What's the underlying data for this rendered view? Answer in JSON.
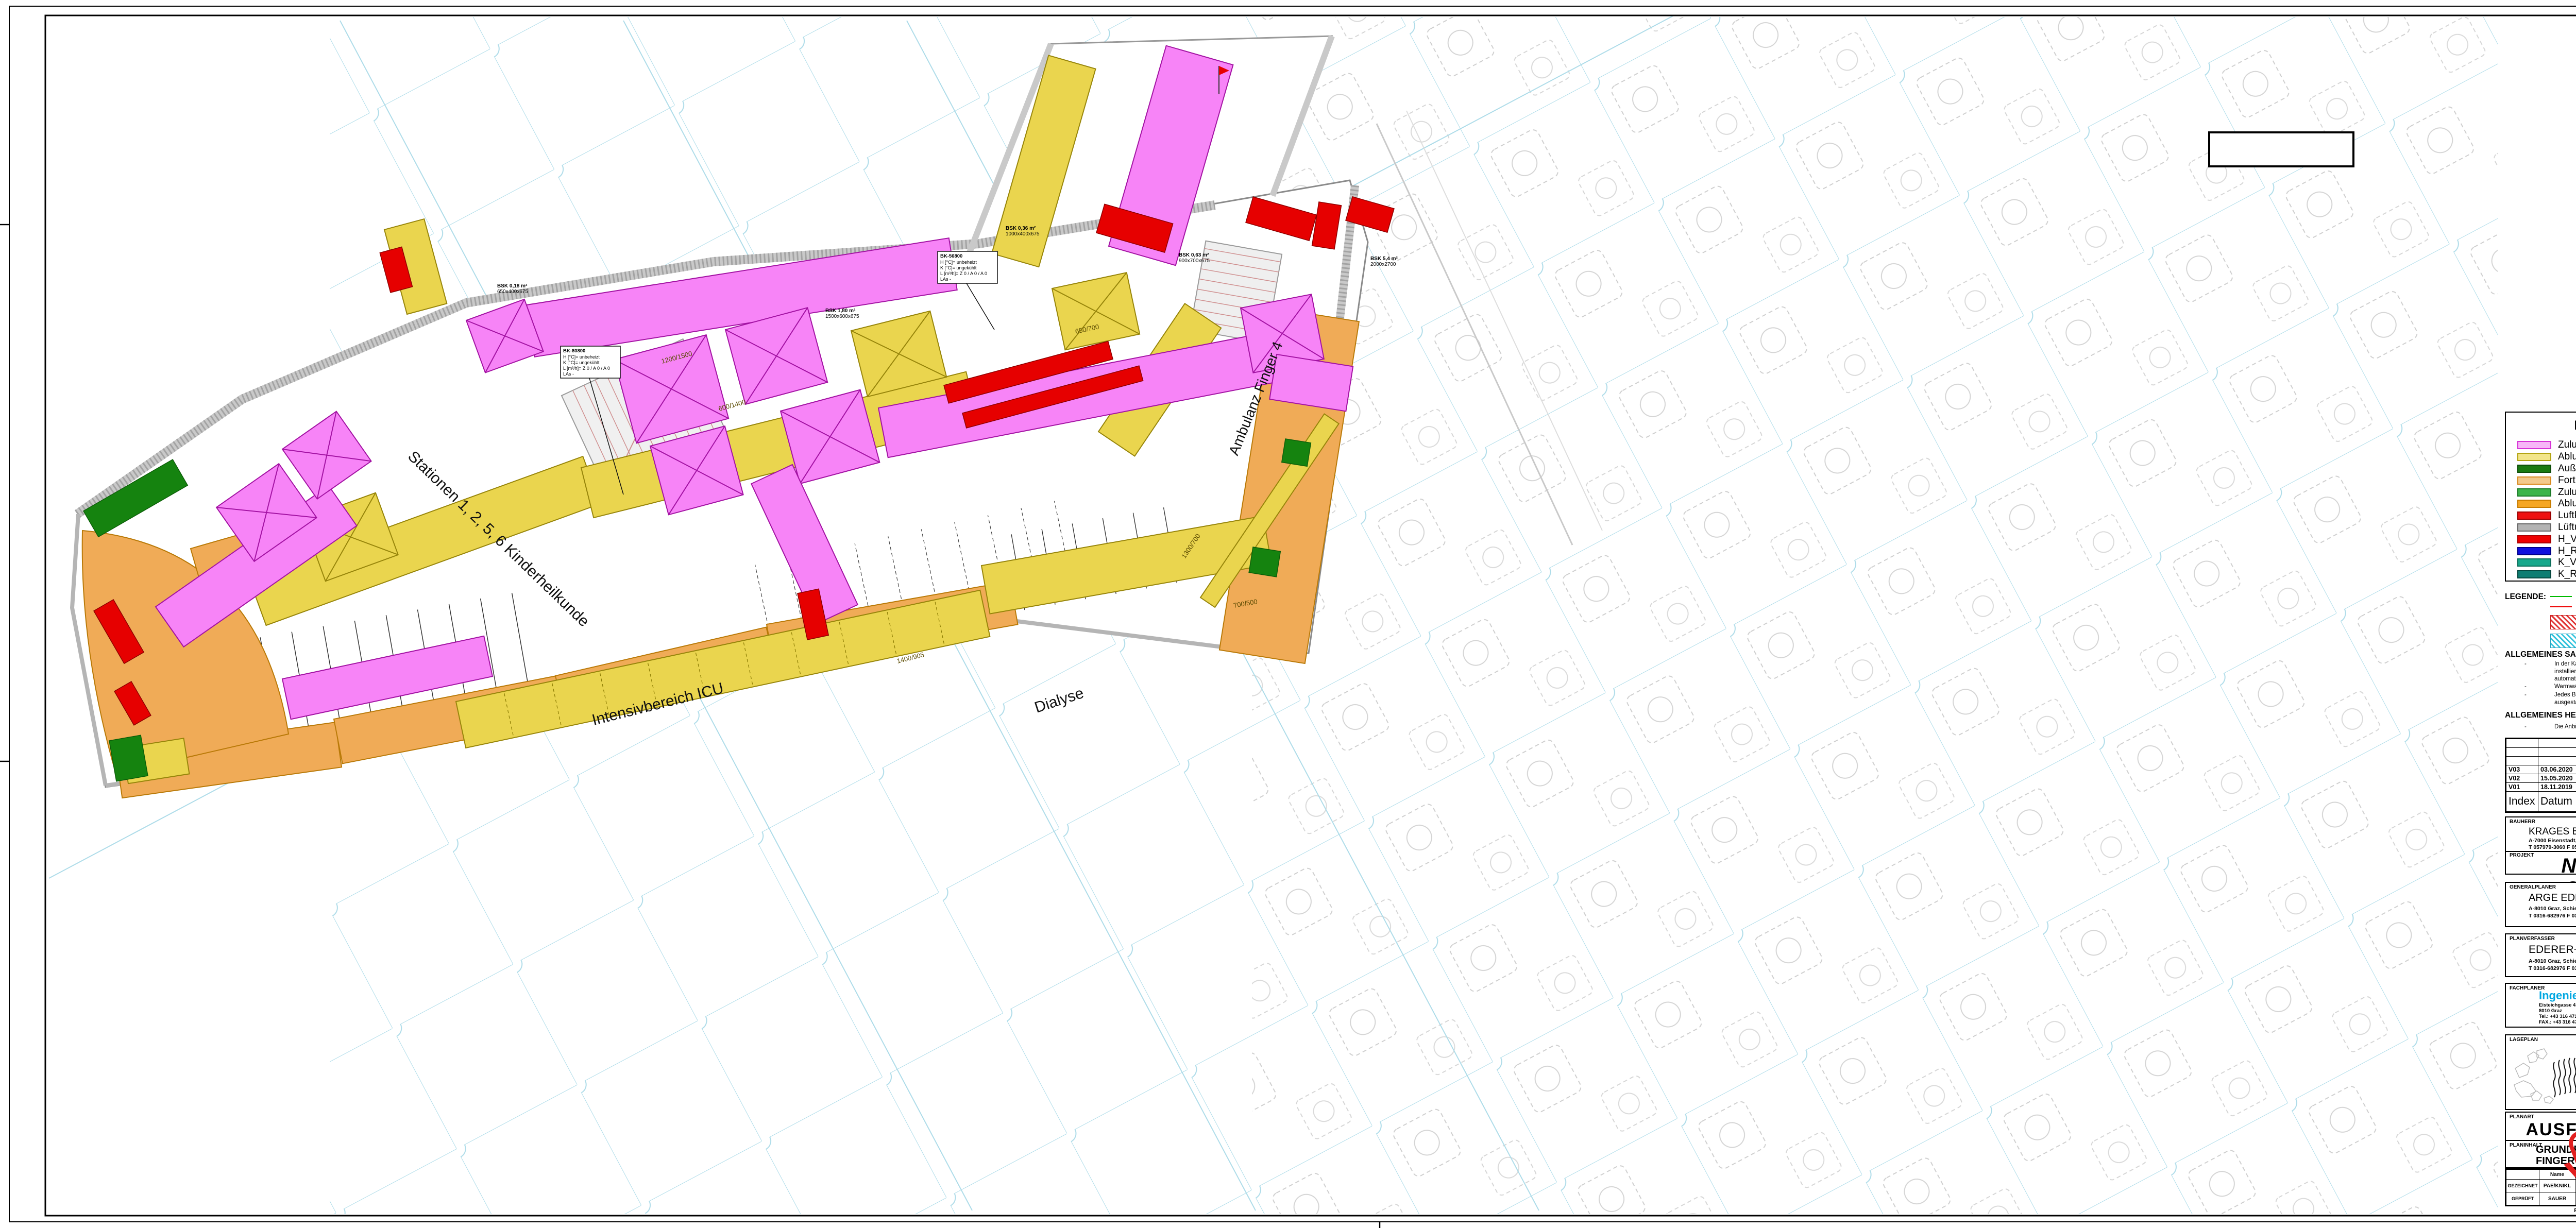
{
  "palette": {
    "zuluft": "#f784f7",
    "abluft": "#ead54e",
    "fortluft": "#f0ab57",
    "aussenluft": "#15830f",
    "damper": "#e60000",
    "wall": "#c9c9c9",
    "grid": "#aedce9",
    "stair": "#cf8f8f"
  },
  "plan": {
    "labels": {
      "stationen": "Stationen 1, 2, 5, 6 Kinderheilkunde",
      "icu": "Intensivbereich ICU",
      "dialyse": "Dialyse",
      "ambulanz": "Ambulanz Finger 4"
    },
    "tags": {
      "bk1": [
        "BK-80800",
        "H [°C]= unbeheizt",
        "K [°C]= ungekühlt",
        "L [m³/h]= Z 0 / A 0 / A 0",
        "LAs -"
      ],
      "bk2": [
        "BK-56800",
        "H [°C]= unbeheizt",
        "K [°C]= ungekühlt",
        "L [m³/h]= Z 0 / A 0 / A 0",
        "LAs -"
      ]
    },
    "bsk": [
      {
        "l1": "BSK 0,36 m²",
        "l2": "1000x400x675"
      },
      {
        "l1": "BSK 5,4 m²",
        "l2": "2000x2700"
      },
      {
        "l1": "BSK 0,63 m²",
        "l2": "900x700x675"
      },
      {
        "l1": "BSK 1,80 m²",
        "l2": "1500x600x675"
      },
      {
        "l1": "BSK 0,18 m²",
        "l2": "650x400x675"
      }
    ],
    "dims": [
      "1400/905",
      "1200/1500",
      "600/1400",
      "650/700",
      "1300/700",
      "700/500"
    ]
  },
  "legend": {
    "title": "LEGENDE-HKLS",
    "left": [
      {
        "label": "Zuluft",
        "fill": "#f7b7f7",
        "stroke": "#d633d6"
      },
      {
        "label": "Abluft",
        "fill": "#f2e58a",
        "stroke": "#b3a412"
      },
      {
        "label": "Außenluft",
        "fill": "#1a7a12",
        "stroke": "#0d4d09"
      },
      {
        "label": "Fortluft",
        "fill": "#f2c98c",
        "stroke": "#d98a1f"
      },
      {
        "label": "Zuluft DBA",
        "fill": "#3cb54a",
        "stroke": "#1c7a28"
      },
      {
        "label": "Abluft DBA",
        "fill": "#f5a623",
        "stroke": "#c77c00"
      },
      {
        "label": "Luftkanalzubehör",
        "fill": "#ee1111",
        "stroke": "#990000"
      },
      {
        "label": "Lüftungsgeräte",
        "fill": "#b3b3b3",
        "stroke": "#666666"
      },
      {
        "label": "H_Vorlauf",
        "fill": "#ee0000",
        "stroke": "#aa0000"
      },
      {
        "label": "H_Rücklauf",
        "fill": "#1010dd",
        "stroke": "#000088"
      },
      {
        "label": "K_Vorlauf",
        "fill": "#18a88c",
        "stroke": "#0c6e5a"
      },
      {
        "label": "K_Rücklauf",
        "fill": "#0e7d72",
        "stroke": "#06483f"
      }
    ],
    "right": [
      {
        "label": "Kaltwasser",
        "fill": "#46d81e",
        "stroke": "#1f9a0a"
      },
      {
        "label": "Warmwasser",
        "fill": "#f07800",
        "stroke": "#aa4e00"
      },
      {
        "label": "Zirkulation",
        "fill": "#ee00ee",
        "stroke": "#990099"
      },
      {
        "label": "VE-Wasser",
        "fill": "#2aa02a",
        "stroke": "#136013"
      },
      {
        "label": "Hydrantenleitung",
        "fill": "#00cc00",
        "stroke": "#008800"
      },
      {
        "label": "Regenabwasser",
        "fill": "#2277bb",
        "stroke": "#114477"
      },
      {
        "label": "Fäkalabwasser",
        "fill": "#6b3a17",
        "stroke": "#3d1f08"
      },
      {
        "label": "Medgase",
        "fill": "#8e97ee",
        "stroke": "#4d55aa"
      },
      {
        "label": "MSR-Schaltkasten",
        "fill": "#f08fa0",
        "stroke": "#c04b60"
      },
      {
        "label": "Sonstige Einrichtungen",
        "fill": "#f5aa5a",
        "stroke": "#c87820"
      }
    ]
  },
  "notes": {
    "legende_label": "LEGENDE:",
    "rohr_kalt": "Rohrtrasse kalt, bestehend aus Trink- und Klimakaltwasserleitungen",
    "rohr_warm": "Rohrtrasse warm, bestehend aus Heizung-, Warmwasser- und Zirkulationsleitung",
    "fbh": "Bereiche mit Fussbodenheizung",
    "fba": "Bereiche mit Fussbodenabsenkung",
    "sanitaer_title": "ALLGEMEINES SANITÄR",
    "sanitaer": [
      "In der Kaltwasserleitung ist am Ende der Verteilleitung ein Spülventil installiert, welches in Abhängigkeit der Zeit und der Temperatur eine automatische Spülung der Leitung durchführt",
      "Warmwasserleitungen werden bis zur Entnahme durchgeschliffen",
      "Jedes Bad bzw. jeder Raum wird über Unterputzabsperrventile ausgestattet"
    ],
    "heizung_title": "ALLGEMEINES HEIZUNG",
    "heizung": [
      "Die Anbindung der Heizkörper erfolgt vom darunterliegenden Geschoß"
    ]
  },
  "revisions": {
    "headers": [
      "Index",
      "Datum",
      "Gezeichn.",
      "Änderung"
    ],
    "rows": [
      [
        "V03",
        "03.06.2020",
        "KNIKL",
        "Diverse Änderungen und Anpassungen"
      ],
      [
        "V02",
        "15.05.2020",
        "KNIKL",
        "Projektanpassungen"
      ],
      [
        "V01",
        "18.11.2019",
        "KOGIE",
        "Diverse Änderungen"
      ]
    ]
  },
  "titleblock": {
    "bauherr": {
      "label": "BAUHERR",
      "name": "KRAGES Burgenländische Krankenanstalten-Ges.m.b.H.",
      "address": "A-7000 Eisenstadt, Josef Hyrtl Platz 4",
      "contact": "T 057979-3060      F 057979-5306      E direktion@krages.at"
    },
    "projekt": {
      "label": "PROJEKT",
      "name": "NEUBAU KH OBERWART"
    },
    "generalplaner": {
      "label": "GENERALPLANER",
      "name": "ARGE EDERER+HAGHIRIAN, GENERALPLAN GMBH",
      "address": "A-8010 Graz, Schießstallgasse 50",
      "contact": "T 0316-682976      F 0316-823951      E office@gpkoh.at"
    },
    "planverfasser": {
      "label": "PLANVERFASSER",
      "name": "EDERER+HAGHIRIAN",
      "address": "A-8010 Graz, Schießstallgasse 50",
      "contact": "T 0316-682976      F 0316-823951      E office@gpkoh.at",
      "zach_logo": "ZACH",
      "zach_name1": "ZACH UND PARTNER",
      "zach_name2": "ZIVILTECHNIKER GMBH",
      "zach_desc1": "PLANUNG ELEKTRO-, MEDIZIN- U. LABOR-",
      "zach_desc2": "TECHNISCHER ANLAGEN U. EINRICHTUNGEN",
      "zach_addr": "8010 GRAZ, NIBELUNGENGASSE 54",
      "zach_tel": "T: 0316/36 15 42  E: office@zt-zach.at"
    },
    "fachplaner": {
      "label": "FACHPLANER",
      "name": "Ingenieurbüro Lang GmbH",
      "addr1": "Eisteichgasse  41",
      "addr2": "8010  Graz",
      "tel": "Tel.:   +43 316 471537",
      "fax": "FAX.: +43 316 471537-9",
      "email": "email:  office@ib-lang.at"
    },
    "insets": {
      "lageplan": "LAGEPLAN",
      "bauteil": "BAUTEIL",
      "f1": "7",
      "f2": "6",
      "f3": "5",
      "f4": "4",
      "f5": "3",
      "f6": "2",
      "f7": "1",
      "ax1": "N",
      "ax2": "M"
    },
    "planart": {
      "label": "PLANART",
      "value": "AUSFÜHRUNGSPLAN"
    },
    "planinhalt": {
      "label": "PLANINHALT",
      "line1": "GRUNDRISS 2.UG",
      "line2": "FINGER 5 NORD - Lüftung"
    },
    "massstab": {
      "label": "Maßstab",
      "value": "1 : 50"
    },
    "sig": {
      "h1": "Name",
      "h2": "Datum",
      "h3": "Plangröße",
      "h4": "Sparte",
      "h5": "PHASE",
      "h6": "INDEX",
      "gezeichnet": "GEZEICHNET",
      "gezeichnet_name": "PAE/KNIKL",
      "gezeichnet_date": "13.09.2019",
      "geprueft": "GEPRÜFT",
      "geprueft_name": "SAUER",
      "geprueft_date": "13.09.2019",
      "plangroesse": "1879x891",
      "sparte": "HKL",
      "phase": "AF",
      "index": "V03"
    },
    "plancode": "Plan-Code/Nr: K5N_HKL_AF_GR_2U_FINGER5NORDLUE_V03.PDF"
  },
  "stamp": "VORABZUG"
}
